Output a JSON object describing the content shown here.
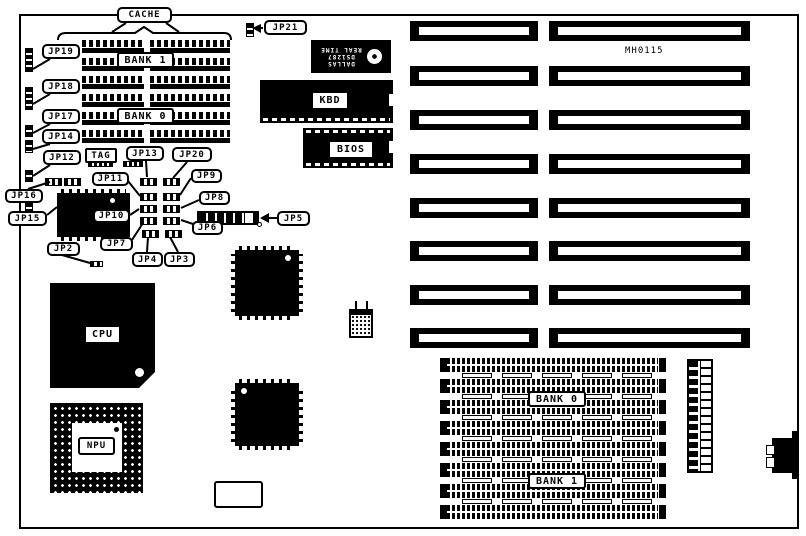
{
  "board": {
    "part_number": "MH0115",
    "cache": {
      "title": "CACHE",
      "bank1": "BANK 1",
      "bank0": "BANK 0",
      "tag": "TAG"
    },
    "chips": {
      "kbd": "KBD",
      "bios": "BIOS",
      "cpu": "CPU",
      "npu": "NPU"
    },
    "rtc": {
      "brand": "DALLAS",
      "model": "DS1287",
      "type": "REAL TIME"
    },
    "memory": {
      "bank0": "BANK 0",
      "bank1": "BANK 1"
    },
    "jumpers": {
      "jp2": "JP2",
      "jp3": "JP3",
      "jp4": "JP4",
      "jp5": "JP5",
      "jp6": "JP6",
      "jp7": "JP7",
      "jp8": "JP8",
      "jp9": "JP9",
      "jp10": "JP10",
      "jp11": "JP11",
      "jp12": "JP12",
      "jp13": "JP13",
      "jp14": "JP14",
      "jp15": "JP15",
      "jp16": "JP16",
      "jp17": "JP17",
      "jp18": "JP18",
      "jp19": "JP19",
      "jp20": "JP20",
      "jp21": "JP21"
    }
  }
}
